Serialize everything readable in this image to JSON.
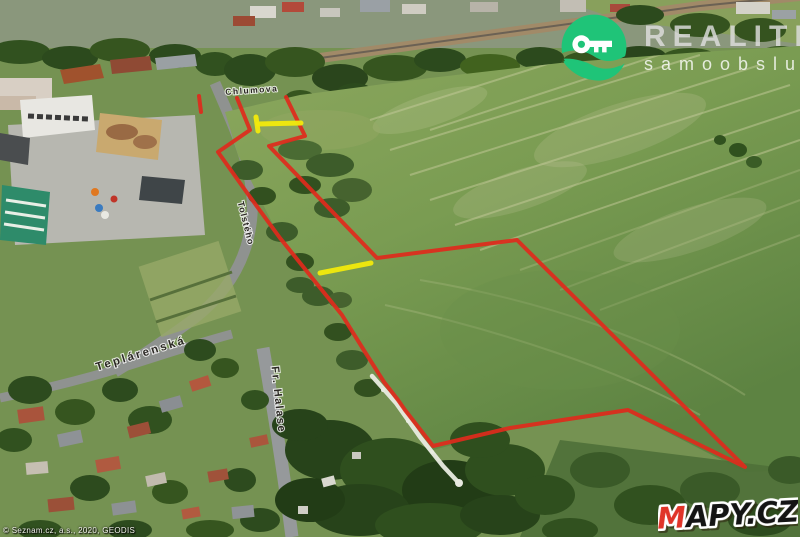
{
  "map": {
    "attribution": "© Seznam.cz, a.s., 2020, GEODIS",
    "street_labels": [
      {
        "text": "Chlumova",
        "x": 252,
        "y": 93,
        "rotate": -4,
        "size": 8.5,
        "spacing": 1.5
      },
      {
        "text": "Tolstého",
        "x": 243,
        "y": 224,
        "rotate": 76,
        "size": 9,
        "spacing": 1
      },
      {
        "text": "Teplárenská",
        "x": 142,
        "y": 357,
        "rotate": -17,
        "size": 11.5,
        "spacing": 2.5
      },
      {
        "text": "Fr. Halase",
        "x": 275,
        "y": 400,
        "rotate": 84,
        "size": 11,
        "spacing": 1.5
      }
    ],
    "overlays": [
      {
        "name": "pipeline",
        "color": "#e9ebe0",
        "width": 4.5,
        "opacity": 0.95,
        "paths": [
          [
            [
              372,
              376
            ],
            [
              396,
              403
            ],
            [
              420,
              437
            ],
            [
              443,
              466
            ],
            [
              457,
              481
            ]
          ]
        ]
      },
      {
        "name": "parcel-boundary",
        "color": "#e02a1c",
        "width": 4,
        "opacity": 0.92,
        "paths": [
          [
            [
              286,
              97
            ],
            [
              305,
              136
            ],
            [
              269,
              146
            ],
            [
              377,
              258
            ],
            [
              517,
              240
            ],
            [
              745,
              467
            ],
            [
              628,
              410
            ],
            [
              510,
              428
            ],
            [
              433,
              446
            ],
            [
              405,
              410
            ],
            [
              398,
              400
            ],
            [
              384,
              382
            ],
            [
              365,
              352
            ],
            [
              342,
              315
            ],
            [
              280,
              238
            ],
            [
              245,
              190
            ],
            [
              218,
              152
            ],
            [
              250,
              130
            ],
            [
              237,
              98
            ]
          ],
          [
            [
              199,
              96
            ],
            [
              201,
              112
            ]
          ]
        ]
      },
      {
        "name": "entrance-marker",
        "color": "#f2ea0c",
        "width": 5,
        "opacity": 0.95,
        "paths": [
          [
            [
              256,
              117
            ],
            [
              258,
              131
            ]
          ],
          [
            [
              258,
              124
            ],
            [
              301,
              123
            ]
          ],
          [
            [
              320,
              273
            ],
            [
              371,
              263
            ]
          ]
        ]
      }
    ]
  },
  "branding": {
    "realitni": {
      "line1": "REALITNÍ",
      "line2": "samoobsluha",
      "icon_color": "#1fc478"
    },
    "mapycz": {
      "text_m": "M",
      "text_rest": "APY.CZ",
      "m_color": "#e03428",
      "rest_color": "#141414"
    }
  }
}
